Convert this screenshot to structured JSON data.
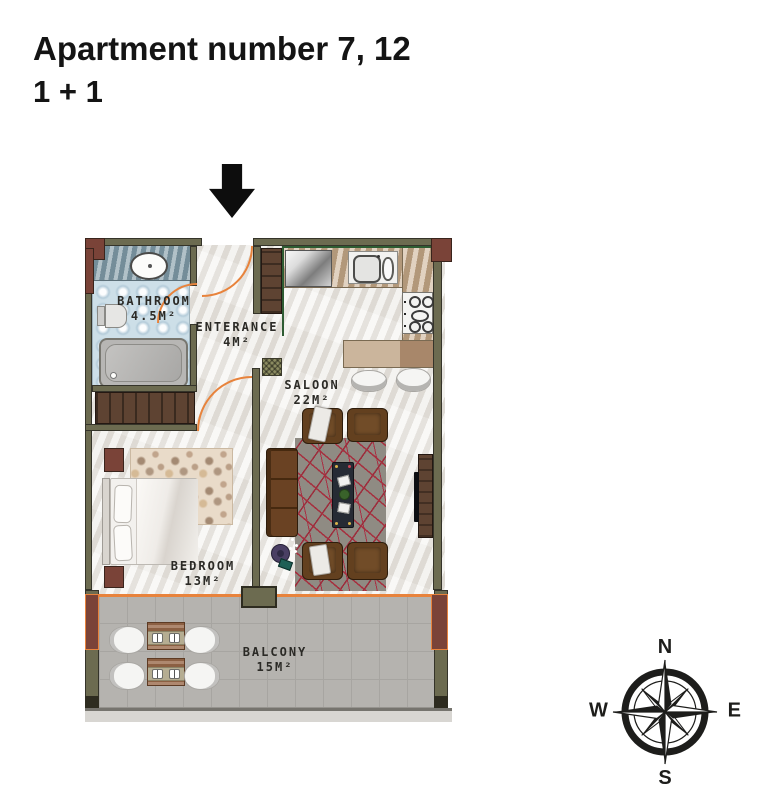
{
  "header": {
    "title": "Apartment number 7, 12",
    "subtitle": "1 + 1"
  },
  "plan": {
    "rooms": {
      "bathroom": {
        "name": "BATHROOM",
        "area": "4.5M²"
      },
      "enterance": {
        "name": "ENTERANCE",
        "area": "4M²"
      },
      "saloon": {
        "name": "SALOON",
        "area": "22M²"
      },
      "bedroom": {
        "name": "BEDROOM",
        "area": "13M²"
      },
      "balcony": {
        "name": "BALCONY",
        "area": "15M²"
      }
    }
  },
  "compass": {
    "north": "N",
    "south": "S",
    "east": "E",
    "west": "W"
  },
  "icons": {
    "entrance_marker": "down-arrow",
    "orientation": "compass-rose"
  },
  "colors": {
    "title_text": "#141414",
    "accent_orange": "#E8833C",
    "wall_olive": "#6C6B50",
    "wall_edge": "#35342A",
    "column_maroon": "#7A4338",
    "wood_dark": "#5E4332",
    "wood_counter": "#C9AE8E",
    "sofa_brown": "#63401F",
    "rug_gray": "#8F8B83",
    "rug_red": "#A6303F",
    "coffee_table": "#262B34",
    "bath_tile_blue": "#CDDFE8",
    "balcony_floor": "#B5B3AF",
    "marble_floor": "#ECEAE5",
    "label_text": "#2B2A26",
    "compass_black": "#1D1D1B"
  }
}
